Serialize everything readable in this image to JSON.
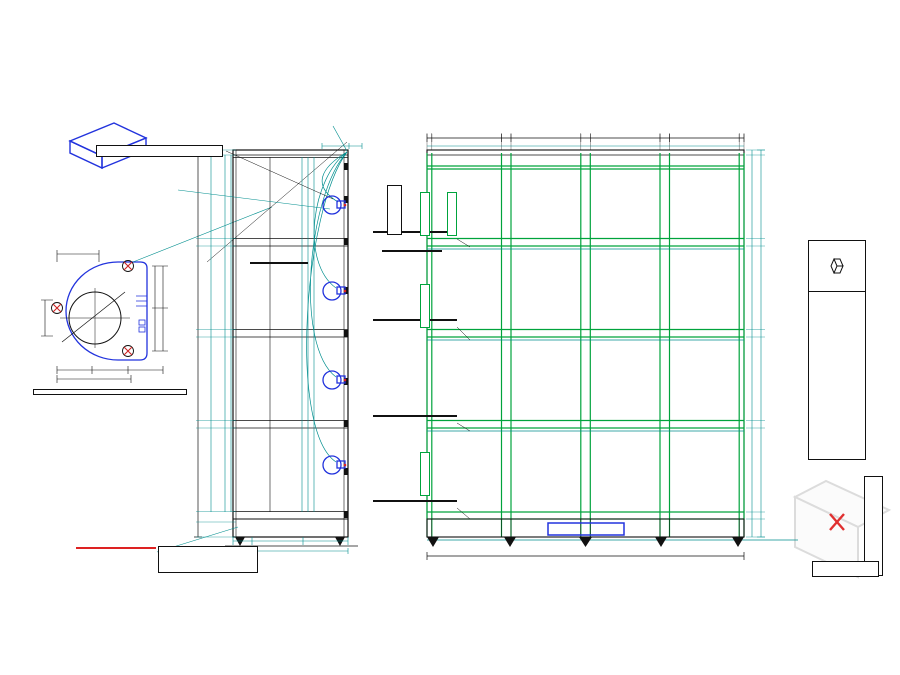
{
  "page": {
    "watermark": "ALSANIT"
  },
  "top": {
    "label_lines": [
      "Electronic lock Gantner GAT NetLock 7000",
      "(wkręty M4)"
    ],
    "count_box": "4 szt. zamków",
    "iso_caption": [
      "Electronic lock Gantner GAT NetLock 7000",
      "controller"
    ]
  },
  "detail": {
    "dims": [
      "25",
      "44",
      "44",
      "88",
      "18,5",
      "Ø 40",
      "37",
      "37",
      "37",
      "74"
    ]
  },
  "note": {
    "lines": [
      "*UWAGA – DRZWI PRAWE",
      "KORPUSY ZAMKÓW, WYCIĘCIA na przewody",
      "w omegach NA LEWEJ ŚCIANIE SKRYTEK",
      "wycięcia w półkach na piony przewodów po",
      "LEWEJ stronie półki (po stronie korpusu",
      "zamka)"
    ]
  },
  "spec": {
    "title": "2 KOMPLETy",
    "lines": [
      "(4pionowy, 4poziomowy)",
      "korpus 1200x1534x480",
      "kolor RAL 9010",
      "powłoka matowa bez ocynku",
      "tulejki zamków  M4",
      "przygotowanie otworów pod zawiasy Ø3mm",
      "DRZWI  prawe"
    ],
    "red_note": [
      "pas – półka w cokole",
      "na kontroler Gantner"
    ],
    "blue_note": [
      "Wyjście przewodów 40L",
      "w cokole (przew.=300W)"
    ]
  },
  "side": {
    "caption": "Metal+HPL 12 – bok",
    "overall": [
      "1534",
      "1415"
    ],
    "left_chain": [
      "20",
      "346",
      "331",
      "30",
      "361",
      "331",
      "30",
      "361",
      "331",
      "30",
      "346",
      "331",
      "100"
    ],
    "top_dims": [
      "50",
      "12"
    ],
    "inner_dims": [
      "366",
      "366",
      "30"
    ],
    "bottom_dims": [
      "40",
      "200",
      "220"
    ],
    "total_w": [
      "480"
    ],
    "shelf_labels": [
      "H półki= 30mm",
      "H półki= 30mm",
      "H półki= 30mm",
      "H cokołu= 100mm"
    ],
    "callout": [
      "wycięcie Ø na",
      "wprowadzenie",
      "przewodu zamka"
    ]
  },
  "front": {
    "caption": "Metal+HPL 12– front",
    "top_dims": [
      "18",
      "264",
      "36",
      "264",
      "36",
      "264",
      "36",
      "264",
      "18"
    ],
    "top_dims2": [
      "292",
      "292",
      "292",
      "292"
    ],
    "right_chain": [
      "20",
      "331",
      "30",
      "331",
      "30",
      "331",
      "30",
      "331",
      "100"
    ],
    "overall_h": [
      "1534"
    ],
    "bottom_w": [
      "1200"
    ],
    "plinth_h": [
      "100"
    ],
    "misc": [
      "18"
    ],
    "callout_szer": [
      "Wycięcie w półkach na",
      "przewody (na szer. 40)"
    ],
    "callout_o3": [
      "Ø3 tylko przez",
      "1 warstwę blachy"
    ],
    "hpl_label": "HPL 12 kolor(0757) 305",
    "green_tag": "HPL 12  305"
  },
  "titleblock": {
    "brand": "ALSANIT",
    "reg": "®",
    "company": [
      "PWI ALSANIT",
      "PL 64-980 Trzcianka, ul. Wieleńska 2",
      "tel. 067-253 23 60, fax 067- 253 23 79",
      "www.alsanit.pl"
    ],
    "doc_no": "1109 + 1168 STOKQ",
    "date": "27.10.2017"
  }
}
